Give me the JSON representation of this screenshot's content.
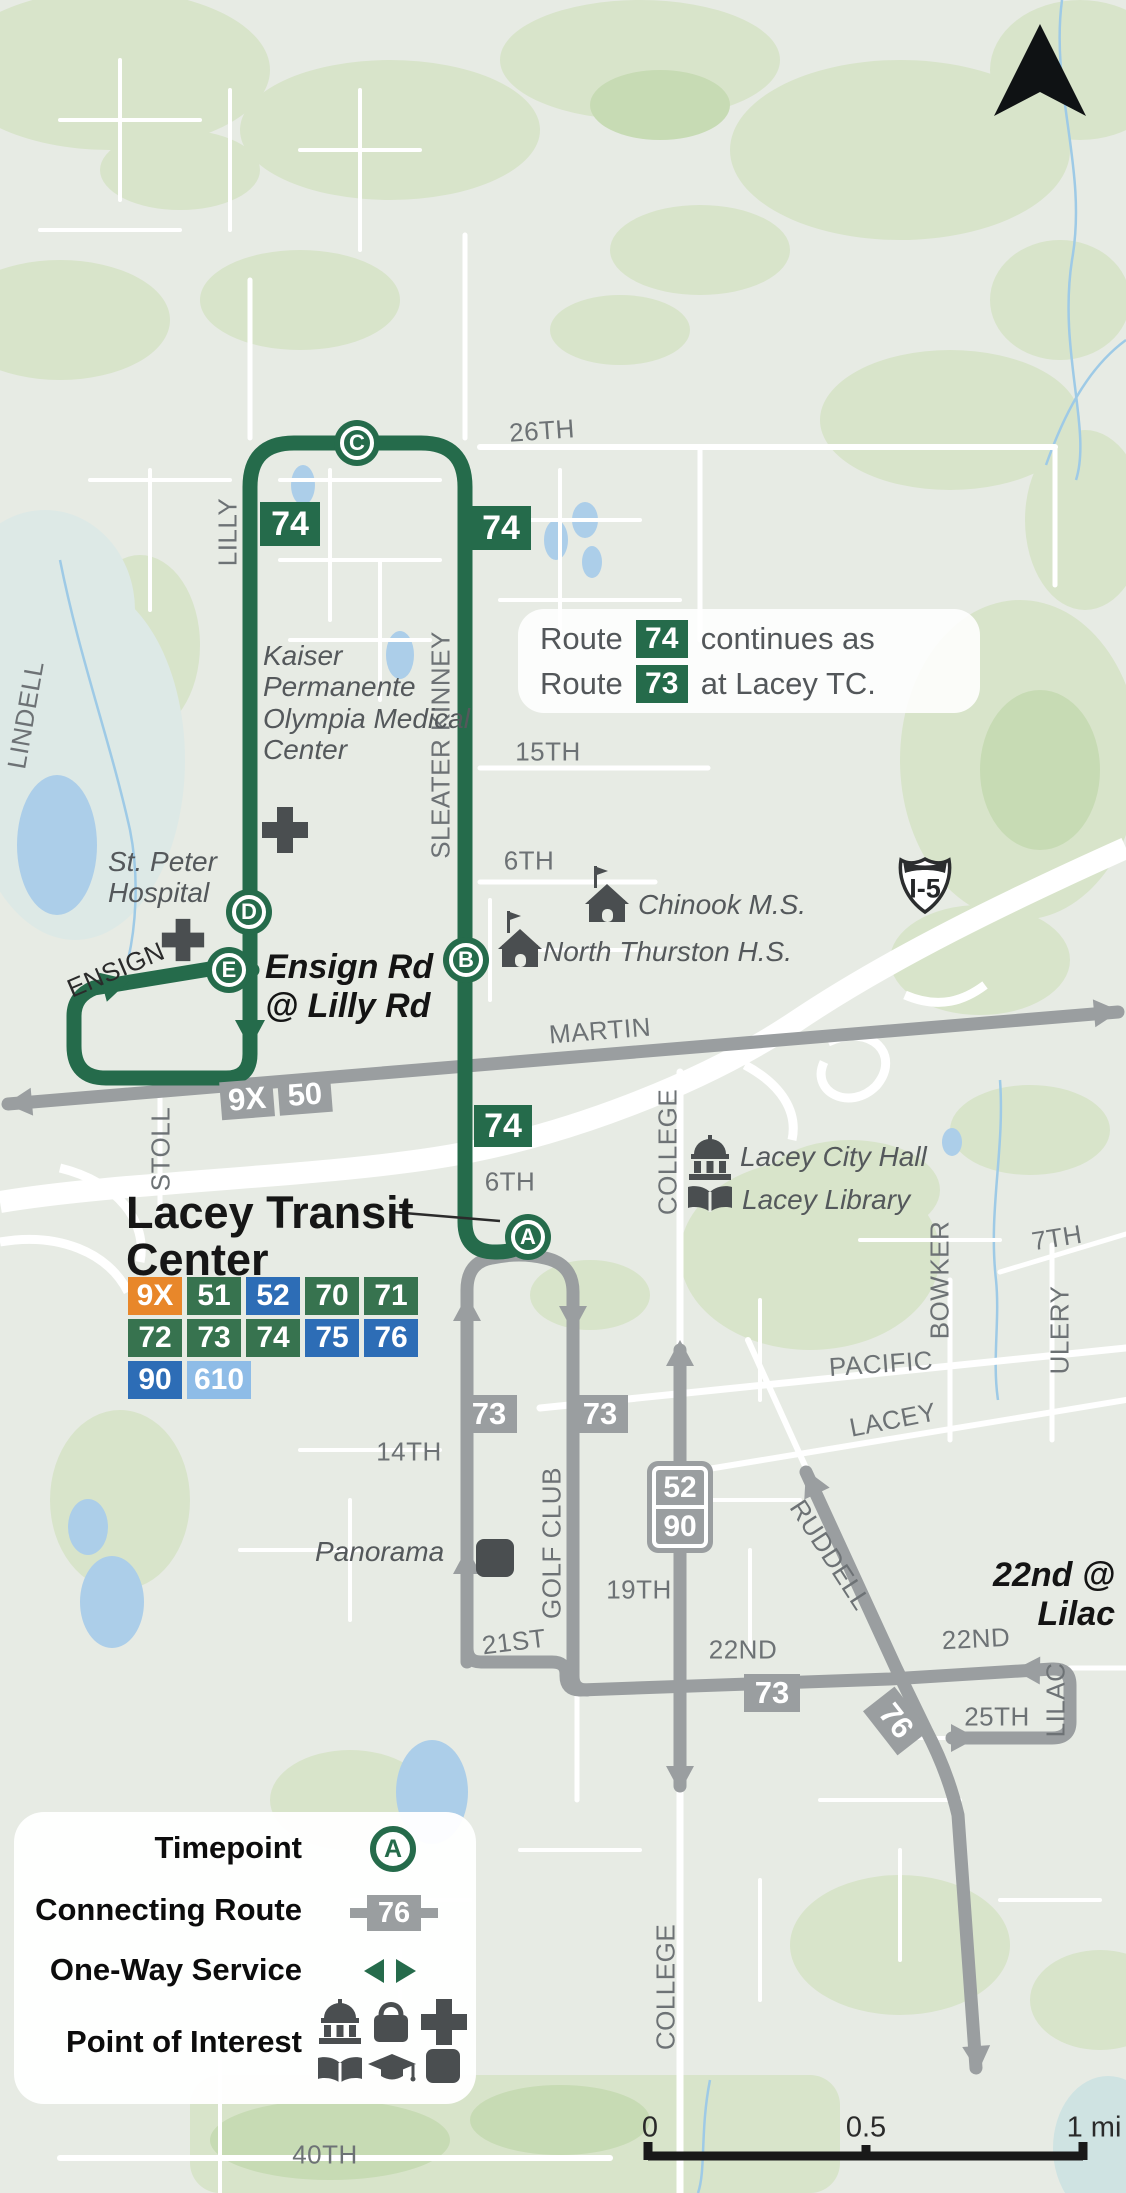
{
  "colors": {
    "route_green": "#256b4b",
    "ltc_badge_green": "#37734f",
    "connecting_gray": "#9a9ea0",
    "badge_orange": "#e8872a",
    "badge_blue": "#2d6db6",
    "badge_light_blue": "#8ebce7"
  },
  "note": {
    "prefix1": "Route",
    "badge1": "74",
    "suffix1": "continues as",
    "prefix2": "Route",
    "badge2": "73",
    "suffix2": "at Lacey TC."
  },
  "highway": {
    "shield": "I-5"
  },
  "streets": {
    "s26th": "26TH",
    "lilly": "LILLY",
    "sleater_kinney": "SLEATER KINNEY",
    "lindell": "LINDELL",
    "s15th": "15TH",
    "s6th": "6TH",
    "martin": "MARTIN",
    "ensign": "ENSIGN",
    "stoll": "STOLL",
    "college": "COLLEGE",
    "pacific": "PACIFIC",
    "lacey": "LACEY",
    "bowker": "BOWKER",
    "s7th": "7TH",
    "ulery": "ULERY",
    "s14th": "14TH",
    "golf_club": "GOLF CLUB",
    "s19th": "19TH",
    "s21st": "21ST",
    "s22nd": "22ND",
    "s25th": "25TH",
    "lilac": "LILAC",
    "ruddell": "RUDDELL",
    "s40th": "40TH"
  },
  "pois": {
    "kaiser": "Kaiser Permanente Olympia Medical Center",
    "st_peter": "St. Peter Hospital",
    "chinook": "Chinook M.S.",
    "north_thurston": "North Thurston H.S.",
    "city_hall": "Lacey City Hall",
    "library": "Lacey Library",
    "panorama": "Panorama"
  },
  "stops": {
    "ensign_line1": "Ensign Rd",
    "ensign_line2": "@ Lilly Rd",
    "lilac_line1": "22nd @",
    "lilac_line2": "Lilac"
  },
  "transit_center": {
    "title1": "Lacey Transit",
    "title2": "Center",
    "badges": [
      {
        "label": "9X",
        "color": "orange"
      },
      {
        "label": "51",
        "color": "green"
      },
      {
        "label": "52",
        "color": "blue"
      },
      {
        "label": "70",
        "color": "green"
      },
      {
        "label": "71",
        "color": "green"
      },
      {
        "label": "72",
        "color": "green"
      },
      {
        "label": "73",
        "color": "green"
      },
      {
        "label": "74",
        "color": "green"
      },
      {
        "label": "75",
        "color": "blue"
      },
      {
        "label": "76",
        "color": "blue"
      },
      {
        "label": "90",
        "color": "blue"
      },
      {
        "label": "610",
        "color": "light_blue"
      }
    ]
  },
  "timepoints": {
    "a": "A",
    "b": "B",
    "c": "C",
    "d": "D",
    "e": "E"
  },
  "route_badges": {
    "r74": "74",
    "r73": "73",
    "r9x": "9X",
    "r50": "50",
    "r52": "52",
    "r90": "90",
    "r76": "76"
  },
  "legend": {
    "timepoint": "Timepoint",
    "connecting": "Connecting Route",
    "one_way": "One-Way Service",
    "poi": "Point of Interest",
    "timepoint_letter": "A",
    "connecting_badge": "76"
  },
  "scale": {
    "start": "0",
    "mid": "0.5",
    "end": "1 mi"
  }
}
